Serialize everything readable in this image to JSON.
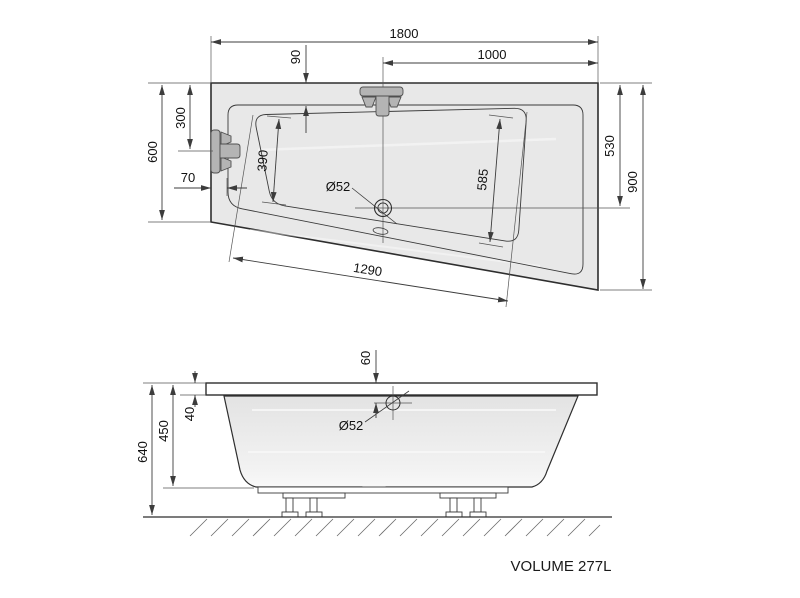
{
  "drawing_title": "Asymmetric bathtub technical drawing",
  "volume_label": "VOLUME 277L",
  "colors": {
    "body_fill": "#e8e8e8",
    "outline": "#2e2e2e",
    "dimension_line": "#3c3c3c",
    "faucet_fill": "#b4b4b4"
  },
  "top_view": {
    "overall_length": "1800",
    "center_to_right_edge": "1000",
    "rim_offset_top": "90",
    "faucet_offset_left": "300",
    "left_end_width": "600",
    "rim_offset_left": "70",
    "bowl_width_left": "390",
    "bowl_width_right": "585",
    "bowl_slant_length": "1290",
    "drain_axis_to_top": "530",
    "right_end_width": "900",
    "drain_diameter": "Ø52"
  },
  "side_view": {
    "drain_offset_from_rim": "60",
    "rim_thickness": "40",
    "tub_body_height": "450",
    "total_height_with_legs": "640",
    "drain_diameter": "Ø52"
  }
}
